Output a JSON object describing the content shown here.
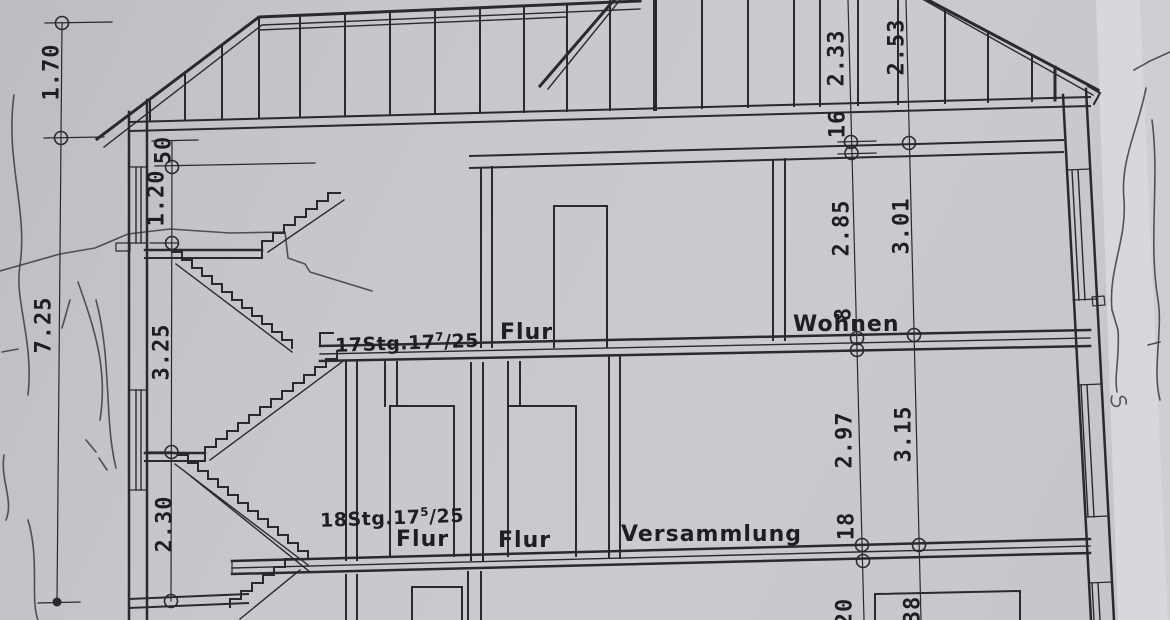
{
  "colors": {
    "paper": "#c7c6cb",
    "paper_edge_band": "#d8d7db",
    "ink": "#2a2930"
  },
  "rooms": {
    "flur_upper": "Flur",
    "wohnen": "Wohnen",
    "flur_mid_1": "Flur",
    "flur_mid_2": "Flur",
    "versammlung": "Versammlung"
  },
  "stairs": {
    "upper": {
      "prefix": "17Stg.17",
      "sup": "7",
      "suffix": "/25"
    },
    "lower": {
      "prefix": "18Stg.17",
      "sup": "5",
      "suffix": "/25"
    }
  },
  "dims": {
    "left_outer": [
      "1.70",
      "7.25"
    ],
    "left_inner": [
      "50",
      "1.20",
      "3.25",
      "2.30"
    ],
    "right_a": [
      "2.33",
      "16",
      "2.85",
      "8",
      "2.97",
      "18",
      "20"
    ],
    "right_b": [
      "2.53",
      "3.01",
      "3.15",
      "38"
    ]
  }
}
